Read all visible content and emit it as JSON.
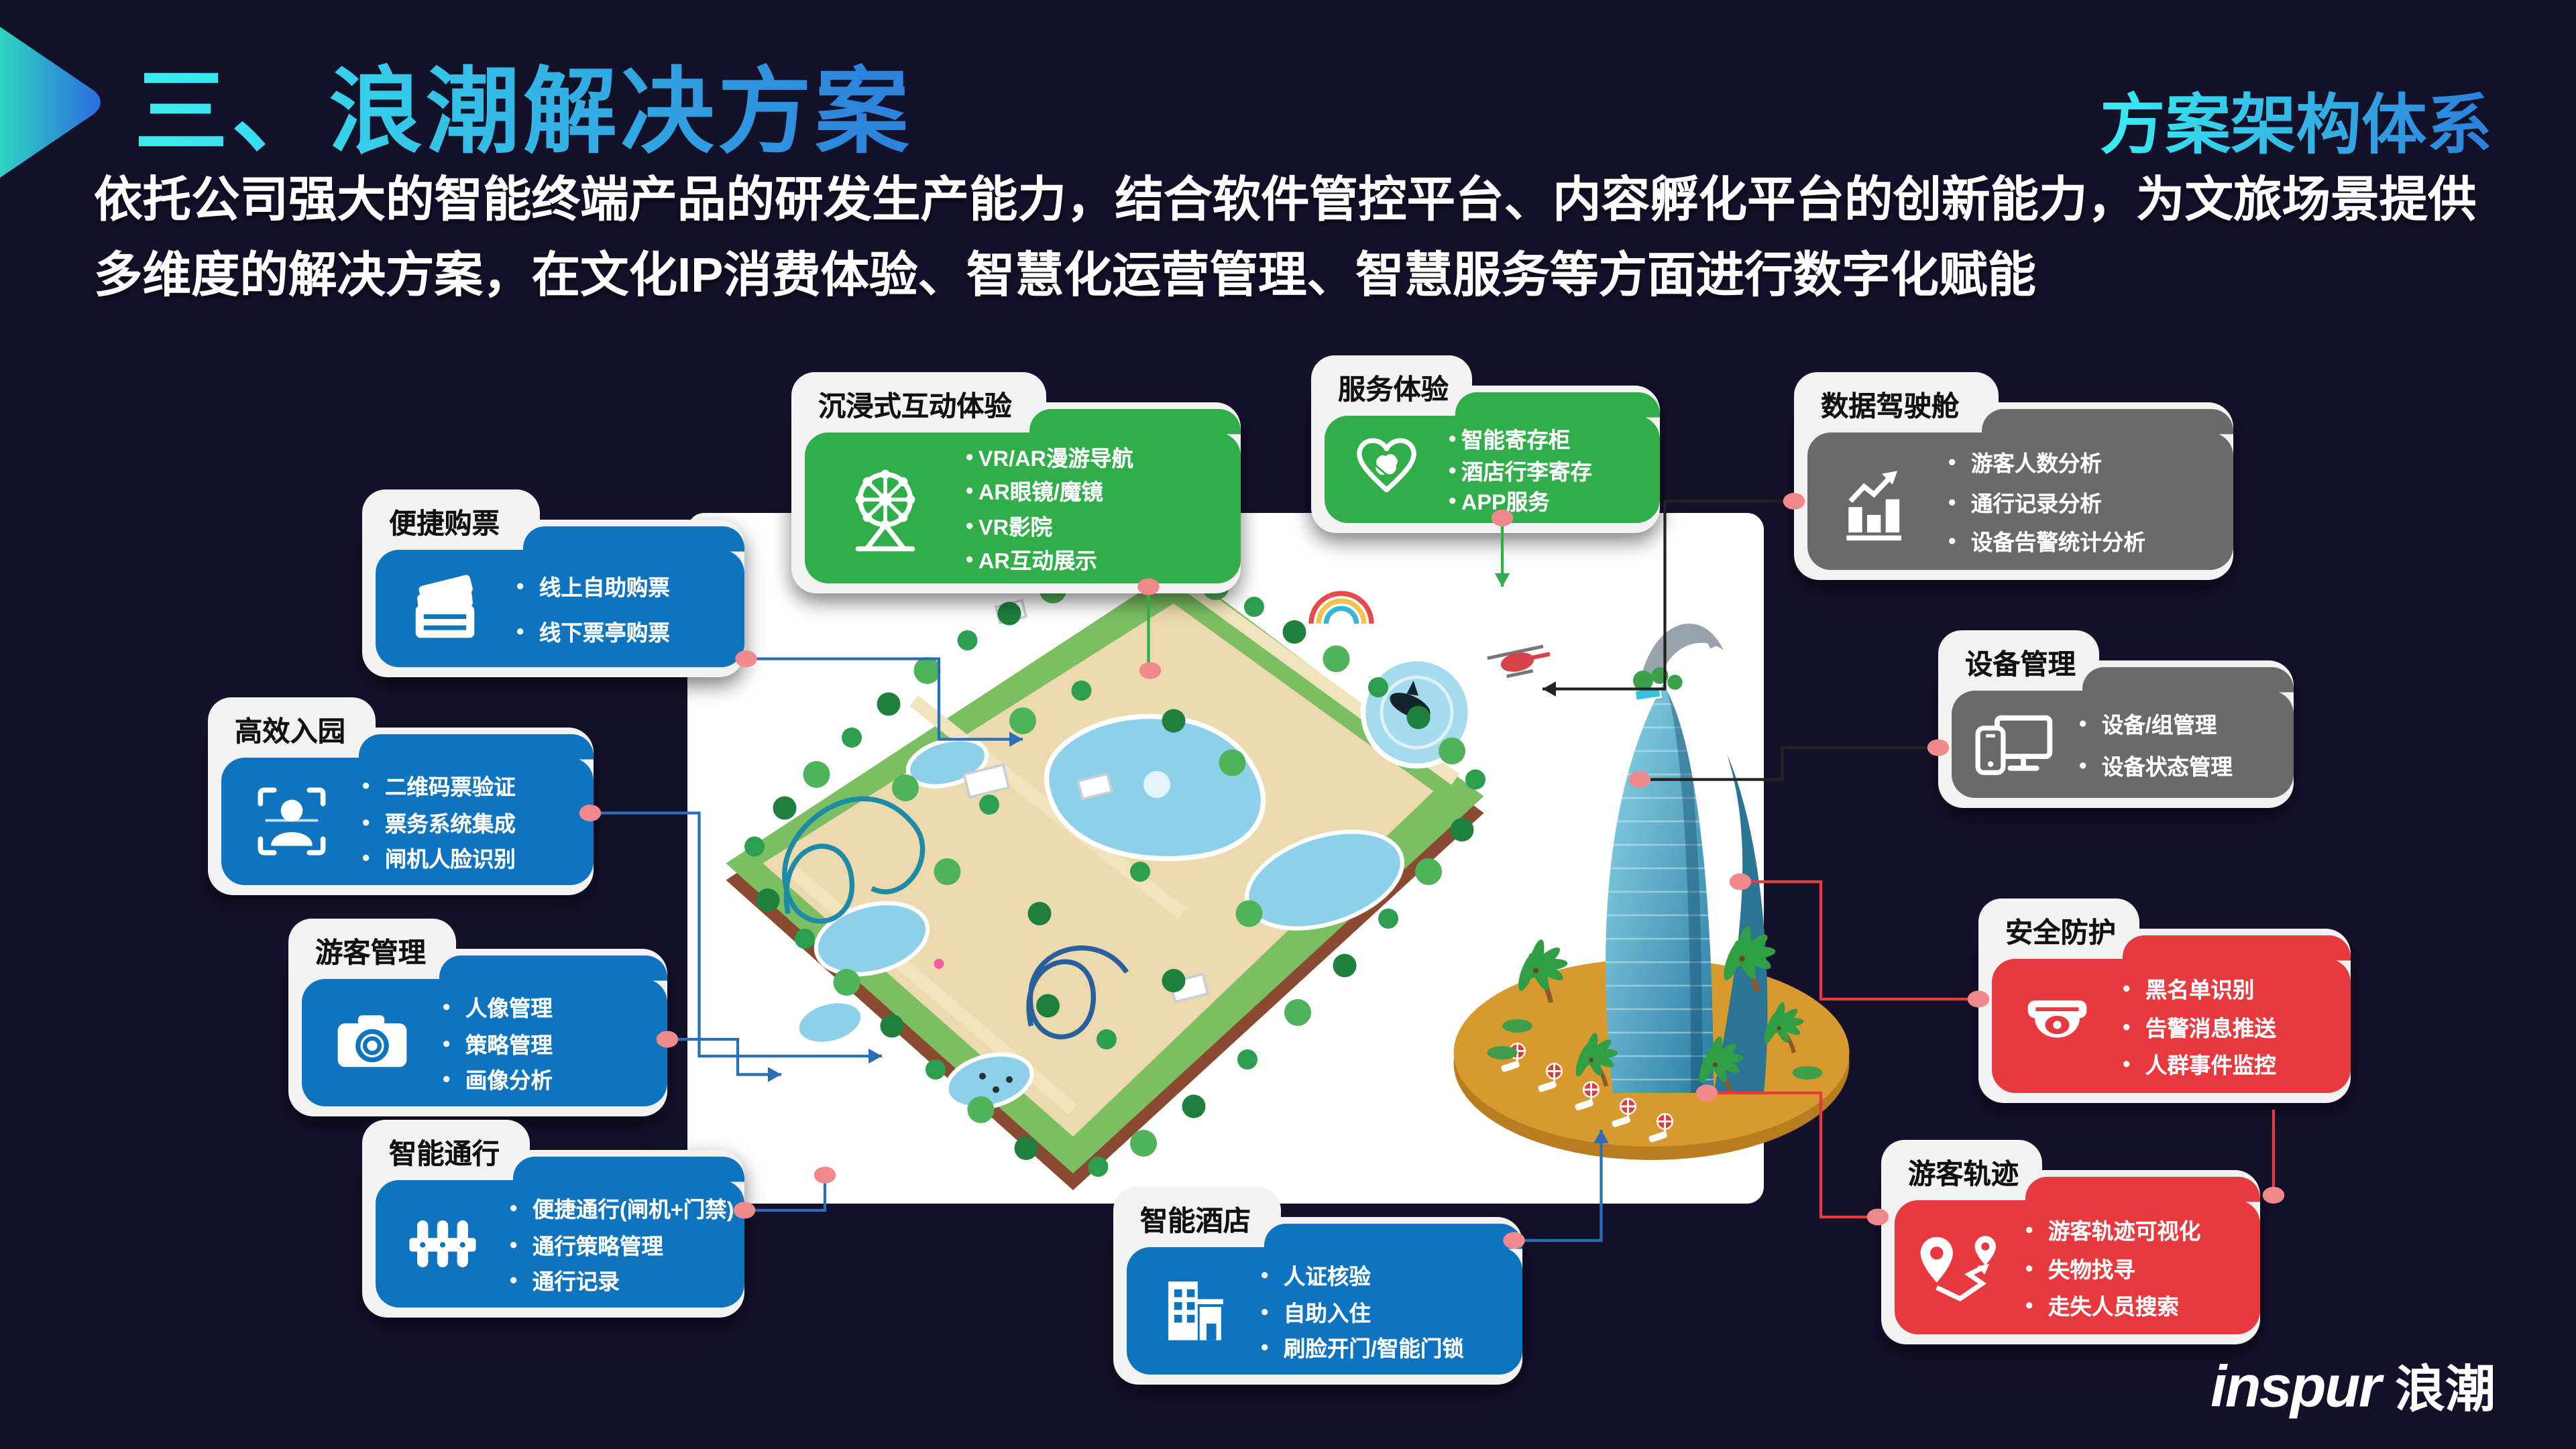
{
  "slide": {
    "title": "三、浪潮解决方案",
    "corner_label": "方案架构体系",
    "description_lines": [
      "依托公司强大的智能终端产品的研发生产能力，结合软件管控平台、内容孵化平台的创新能力，为文旅场景提供",
      "多维度的解决方案，在文化IP消费体验、智慧化运营管理、智慧服务等方面进行数字化赋能"
    ],
    "logo_latin": "inspur",
    "logo_cjk": "浪潮"
  },
  "palette": {
    "background": "#14112B",
    "title_gradient": [
      "#3BE9EF",
      "#2C83DB"
    ],
    "text_white": "#FFFFFF",
    "folder_white": "#F2F2F2",
    "tab_text": "#111111",
    "callout_green": "#2FAE49",
    "callout_blue": "#0E74C0",
    "callout_gray": "#6A6A6A",
    "callout_red": "#E8393E",
    "connector_dot_pink": "#F0898B",
    "line_blue": "#2C6DB8",
    "line_green": "#2FAE49",
    "line_black": "#222222",
    "line_red": "#E8393E",
    "panel_white": "#FFFFFF",
    "island_gold": "#D89A2E",
    "park_green": "#7CBF63",
    "water_blue": "#8ECFE9",
    "tower_blue": "#4FA8C9"
  },
  "callouts": [
    {
      "id": "immersive",
      "title": "沉浸式互动体验",
      "color": "green",
      "icon": "ferris-wheel-icon",
      "items": [
        "VR/AR漫游导航",
        "AR眼镜/魔镜",
        "VR影院",
        "AR互动展示"
      ]
    },
    {
      "id": "service",
      "title": "服务体验",
      "color": "green",
      "icon": "handshake-icon",
      "items": [
        "智能寄存柜",
        "酒店行李寄存",
        "APP服务"
      ]
    },
    {
      "id": "data-cockpit",
      "title": "数据驾驶舱",
      "color": "gray",
      "icon": "bar-chart-icon",
      "items": [
        "游客人数分析",
        "通行记录分析",
        "设备告警统计分析"
      ]
    },
    {
      "id": "ticketing",
      "title": "便捷购票",
      "color": "blue",
      "icon": "tickets-icon",
      "items": [
        "线上自助购票",
        "线下票亭购票"
      ]
    },
    {
      "id": "entry",
      "title": "高效入园",
      "color": "blue",
      "icon": "face-scan-icon",
      "items": [
        "二维码票验证",
        "票务系统集成",
        "闸机人脸识别"
      ]
    },
    {
      "id": "visitor-mgmt",
      "title": "游客管理",
      "color": "blue",
      "icon": "camera-icon",
      "items": [
        "人像管理",
        "策略管理",
        "画像分析"
      ]
    },
    {
      "id": "smart-access",
      "title": "智能通行",
      "color": "blue",
      "icon": "gate-icon",
      "items": [
        "便捷通行(闸机+门禁)",
        "通行策略管理",
        "通行记录"
      ]
    },
    {
      "id": "smart-hotel",
      "title": "智能酒店",
      "color": "blue",
      "icon": "hotel-icon",
      "items": [
        "人证核验",
        "自助入住",
        "刷脸开门/智能门锁"
      ]
    },
    {
      "id": "device-mgmt",
      "title": "设备管理",
      "color": "gray",
      "icon": "devices-icon",
      "items": [
        "设备/组管理",
        "设备状态管理"
      ]
    },
    {
      "id": "security",
      "title": "安全防护",
      "color": "red",
      "icon": "cctv-icon",
      "items": [
        "黑名单识别",
        "告警消息推送",
        "人群事件监控"
      ]
    },
    {
      "id": "visitor-track",
      "title": "游客轨迹",
      "color": "red",
      "icon": "route-icon",
      "items": [
        "游客轨迹可视化",
        "失物找寻",
        "走失人员搜索"
      ]
    }
  ]
}
